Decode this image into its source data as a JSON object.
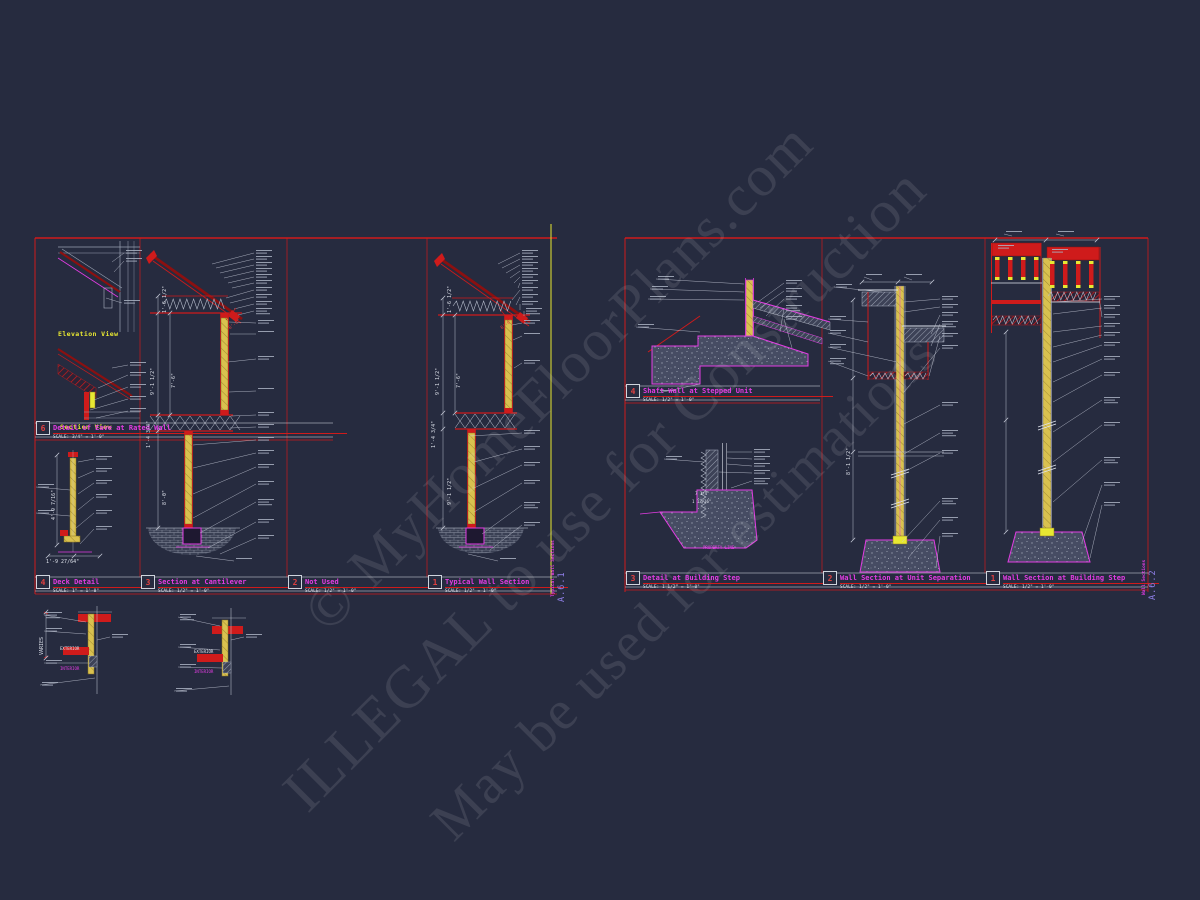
{
  "watermark": {
    "line1": "© MyHomeFloorPlans.com",
    "line2": "ILLEGAL to use for Construction",
    "line3": "May be used for estimations"
  },
  "colors": {
    "background": "#262b3f",
    "red": "#cf1b1b",
    "dark_red": "#8c1010",
    "magenta": "#e33ce3",
    "yellow": "#e8e832",
    "stud_yellow": "#d9c14f",
    "white": "#dfe3ec",
    "concrete_gray": "#8e94a4",
    "sheet_number_purple": "#8f7fe8"
  },
  "left_sheet": {
    "sheet_number": "A.6.1",
    "sheet_title": "Typical Wall Sections",
    "view_labels": {
      "elevation": "Elevation View",
      "section": "Section View"
    },
    "titles": {
      "eave": {
        "num": "6",
        "title": "Detail of Eave at Rated Wall",
        "scale": "SCALE: 3/4\" = 1'-0\""
      },
      "deck": {
        "num": "4",
        "title": "Deck Detail",
        "scale": "SCALE: 1\" = 1'-0\""
      },
      "cantilever": {
        "num": "3",
        "title": "Section at Cantilever",
        "scale": "SCALE: 1/2\" = 1'-0\""
      },
      "notused": {
        "num": "2",
        "title": "Not Used",
        "scale": "SCALE: 1/2\" = 1'-0\""
      },
      "typical": {
        "num": "1",
        "title": "Typical Wall Section",
        "scale": "SCALE: 1/2\" = 1'-0\""
      }
    },
    "dims": {
      "b_top": "1'-6 1/2\"",
      "b_wall": "9'-1 1/2\"",
      "b_clear": "7'-6\"",
      "b_floor": "1'-4 3/4\"",
      "b_lower": "8'-0\"",
      "b_red": "8'-0\"",
      "d_top": "1'-6 1/2\"",
      "d_wall": "9'-1 1/2\"",
      "d_clear": "7'-6\"",
      "d_floor": "1'-4 3/4\"",
      "d_lower": "9'-1 1/2\"",
      "d_red": "8'-0\"",
      "deck_v": "4'-9 7/16\"",
      "deck_h": "1'-9 27/64\""
    }
  },
  "right_sheet": {
    "sheet_number": "A.6.2",
    "sheet_title": "Wall Sections",
    "titles": {
      "shaft": {
        "num": "4",
        "title": "Shaft Wall at Stepped Unit",
        "scale": "SCALE: 1/2\" = 1'-0\""
      },
      "step_detail": {
        "num": "3",
        "title": "Detail at Building Step",
        "scale": "SCALE: 1 1/2\" = 1'-0\""
      },
      "unit_sep": {
        "num": "2",
        "title": "Wall Section at Unit Separation",
        "scale": "SCALE: 1/2\" = 1'-0\""
      },
      "bldg_step": {
        "num": "1",
        "title": "Wall Section at Building Step",
        "scale": "SCALE: 1/2\" = 1'-0\""
      }
    },
    "labels": {
      "property_line": "PROPERTY LINE"
    },
    "dims": {
      "sep_wall": "8'-1 1/2\"",
      "step_a": "7 1/4\"",
      "step_b": "1 13/16\""
    }
  },
  "base_details": {
    "varies": "VARIES",
    "left": {
      "exterior": "EXTERIOR",
      "interior": "INTERIOR"
    },
    "right": {
      "exterior": "EXTERIOR",
      "interior": "INTERIOR"
    }
  }
}
